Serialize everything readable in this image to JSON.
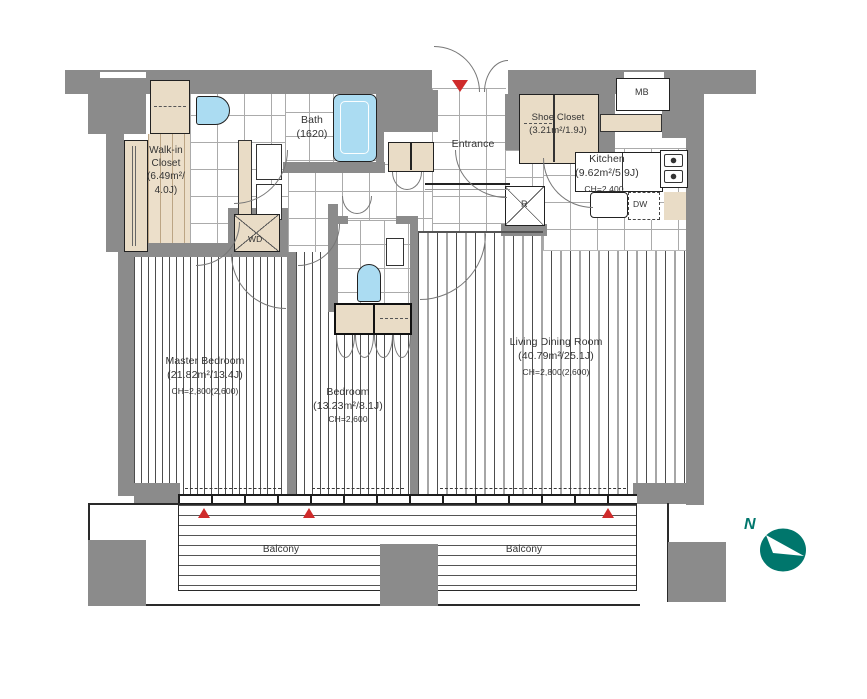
{
  "rooms": {
    "walk_in_closet": {
      "label": "Walk-in\nCloset\n(6.49m²/\n4.0J)"
    },
    "bath": {
      "label": "Bath\n(1620)"
    },
    "entrance": {
      "label": "Entrance"
    },
    "shoe_closet": {
      "label": "Shoe Closet\n(3.21m²/1.9J)"
    },
    "kitchen": {
      "label": "Kitchen\n(9.62m²/5.9J)",
      "ceiling": "CH=2,400"
    },
    "master_bedroom": {
      "label": "Master Bedroom\n(21.82m²/13.4J)",
      "ceiling": "CH=2,800(2,600)"
    },
    "bedroom": {
      "label": "Bedroom\n(13.23m²/8.1J)",
      "ceiling": "CH=2,600"
    },
    "living_dining": {
      "label": "Living Dining Room\n(40.79m²/25.1J)",
      "ceiling": "CH=2,800(2,600)"
    },
    "balcony_left": {
      "label": "Balcony"
    },
    "balcony_right": {
      "label": "Balcony"
    }
  },
  "equipment": {
    "washer_dryer": "WD",
    "refrigerator": "R",
    "dishwasher": "DW",
    "meter_box": "MB"
  },
  "compass": {
    "north": "N"
  },
  "colors": {
    "wall": "#8b8b8b",
    "cabinet": "#e9dcc6",
    "fixture_blue": "#abdcf2",
    "compass_teal": "#00766c",
    "marker_red": "#cf2b2b"
  }
}
